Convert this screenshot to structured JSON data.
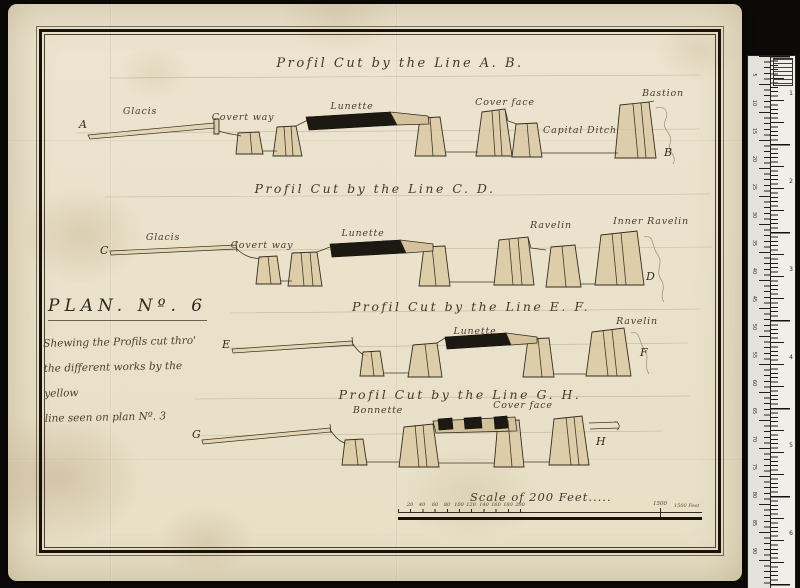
{
  "document": {
    "background_color": "#0b0a08",
    "paper_color": "#ece4cf",
    "ink_color": "#3b3427"
  },
  "plan_block": {
    "heading": "PLAN. Nº. 6",
    "caption_lines": [
      "Shewing the Profils cut thro'",
      "the different works by the yellow",
      "line seen on plan Nº. 3"
    ]
  },
  "profiles": [
    {
      "title": "Profil Cut by the Line A. B.",
      "start_letter": "A",
      "end_letter": "B",
      "labels": [
        "Glacis",
        "Covert way",
        "Lunette",
        "Cover face",
        "Capital Ditch",
        "Bastion"
      ]
    },
    {
      "title": "Profil Cut by the Line C. D.",
      "start_letter": "C",
      "end_letter": "D",
      "labels": [
        "Glacis",
        "Covert way",
        "Lunette",
        "Ravelin",
        "Inner Ravelin"
      ]
    },
    {
      "title": "Profil Cut by the Line E. F.",
      "start_letter": "E",
      "end_letter": "F",
      "labels": [
        "Lunette",
        "Ravelin"
      ]
    },
    {
      "title": "Profil Cut by the Line G. H.",
      "start_letter": "G",
      "end_letter": "H",
      "labels": [
        "Bonnette",
        "Cover face"
      ]
    }
  ],
  "scale": {
    "caption": "Scale of 200 Feet.....",
    "tick_labels": [
      "20",
      "40",
      "60",
      "80",
      "100",
      "120",
      "140",
      "160",
      "180",
      "200"
    ],
    "extended_tick_label": "1500",
    "end_note": "1500 Feet"
  },
  "ruler": {
    "left_numbers": [
      "5",
      "10",
      "15",
      "20",
      "25",
      "30",
      "35",
      "40",
      "45",
      "50",
      "55",
      "60",
      "65",
      "70",
      "75",
      "80",
      "85",
      "90"
    ],
    "right_numbers": [
      "1",
      "2",
      "3",
      "4",
      "5",
      "6"
    ]
  }
}
